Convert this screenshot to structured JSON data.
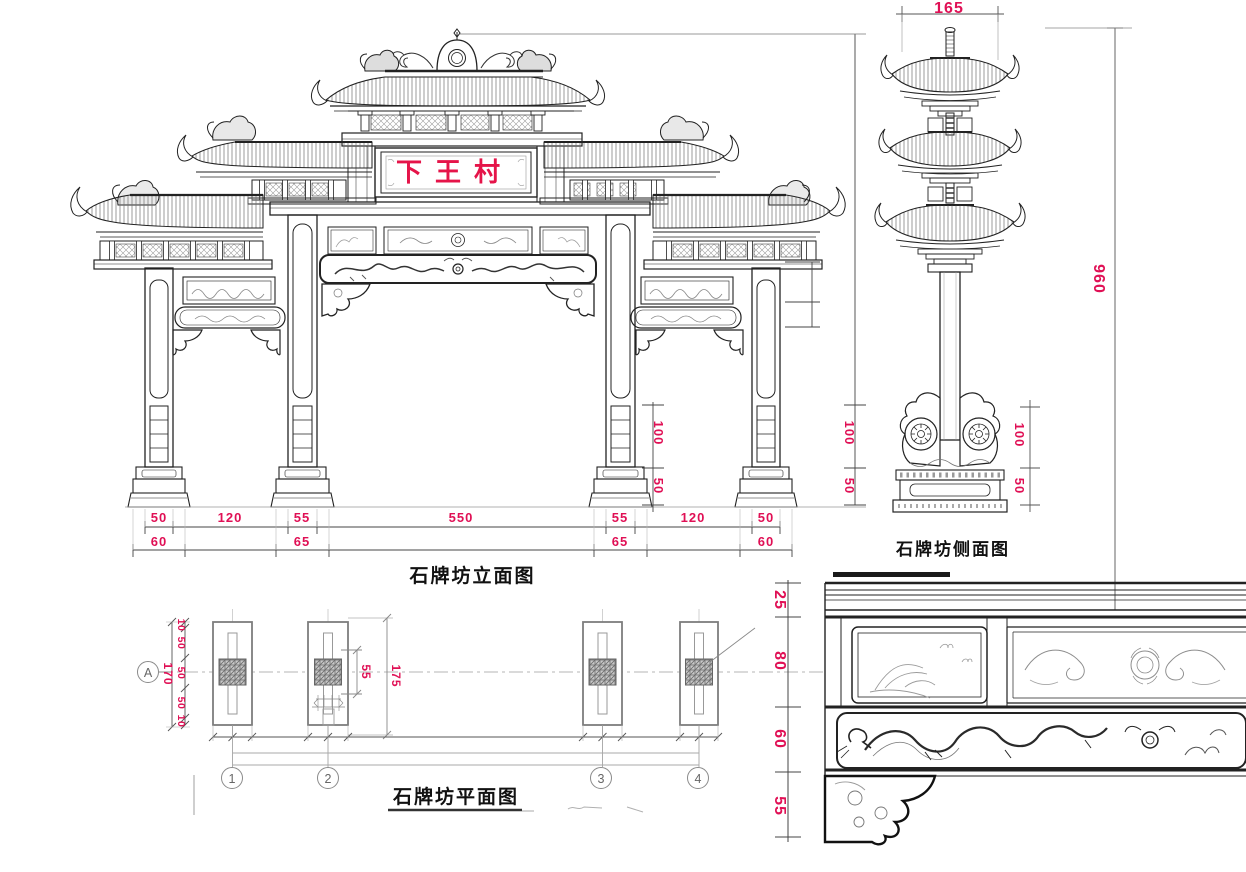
{
  "colors": {
    "dim": "#e01055",
    "plaque": "#e51449",
    "ink": "#222222"
  },
  "elevation": {
    "title": "石牌坊立面图",
    "plaque_text": "下王村",
    "width_dims": [
      "50",
      "120",
      "55",
      "550",
      "55",
      "120",
      "50"
    ],
    "base_dims": [
      "60",
      "65",
      "65",
      "60"
    ],
    "inner_height_dims": [
      "100",
      "50"
    ],
    "right_height_dims": [
      "100",
      "50"
    ]
  },
  "side_view": {
    "title": "石牌坊侧面图",
    "top_width_dim": "165",
    "total_height_dim": "960",
    "base_height_dims": [
      "100",
      "50"
    ]
  },
  "plan_view": {
    "title": "石牌坊平面图",
    "row_axis": "A",
    "column_axes": [
      "1",
      "2",
      "3",
      "4"
    ],
    "depth_chain_dims": [
      "10",
      "50",
      "50",
      "50",
      "10"
    ],
    "depth_total_dim": "170",
    "column_width_dim": "55",
    "foundation_depth_dim": "175"
  },
  "detail_view": {
    "band_dims": [
      "25",
      "80",
      "60",
      "55"
    ]
  }
}
